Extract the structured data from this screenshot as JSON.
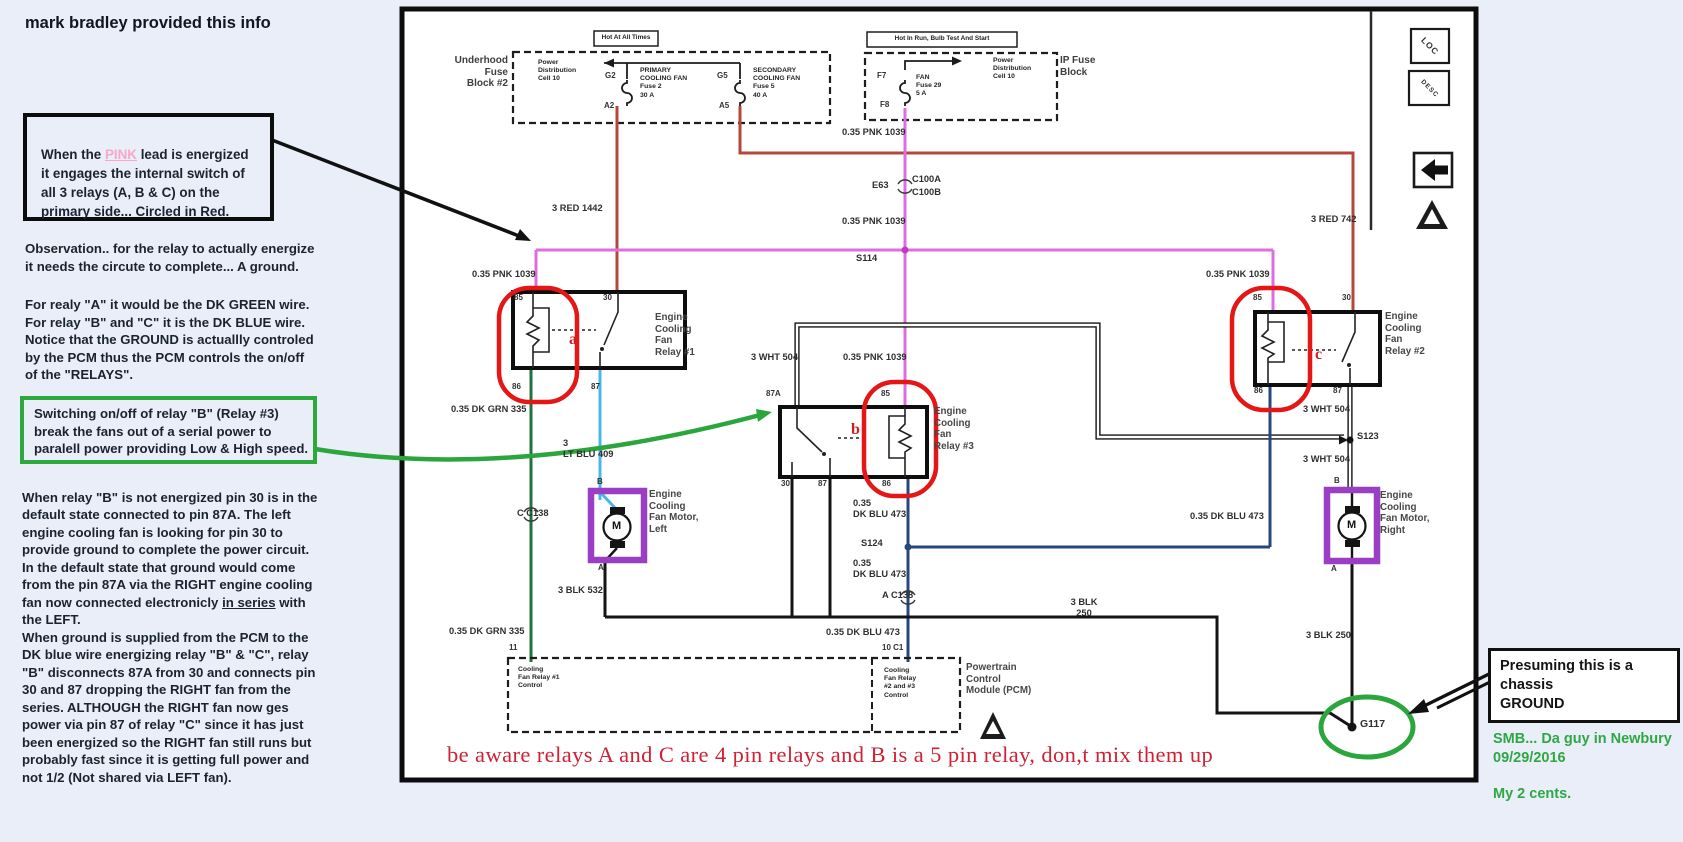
{
  "title": "mark bradley provided this info",
  "notes": {
    "pink_line1_pre": "When the ",
    "pink_word": "PINK",
    "pink_line1_post": " lead is energized",
    "pink_rest": "\nit engages the internal switch of\nall 3  relays (A, B & C) on the\nprimary side... Circled in Red.",
    "observation": "Observation.. for the relay to actually energize\nit needs the circute to complete... A ground.",
    "relay_wires": "For realy \"A\" it would be the DK GREEN wire.\nFor relay \"B\" and \"C\" it is the DK BLUE wire.\nNotice that the GROUND is actuallly controled\nby the PCM thus the PCM controls the on/off\nof the \"RELAYS\".",
    "green_note": "Switching on/off of relay  \"B\" (Relay #3)\nbreak the fans out of a serial power to\nparalell power  providing Low & High speed.",
    "long_a": "When relay \"B\" is not energized pin 30 is in the\ndefault state connected to pin 87A.  The left\nengine cooling fan is looking for pin 30 to\nprovide ground to complete the power circuit.\nIn the default state that ground would come\nfrom the pin 87A via the RIGHT engine cooling\nfan now connected electronicly ",
    "long_u": "in series",
    "long_b": " with\nthe LEFT.\nWhen ground is supplied from the PCM to the\nDK blue wire energizing relay \"B\" & \"C\", relay\n\"B\" disconnects 87A from 30 and connects pin\n30 and 87 dropping the RIGHT fan from the\nseries. ALTHOUGH the RIGHT fan now ges\npower via pin 87 of relay \"C\" since it has just\nbeen energized so the RIGHT fan still runs but\nprobably fast  since it is getting full power and\nnot 1/2   (Not shared via LEFT fan).",
    "red_warning": "be aware relays A and C are 4 pin relays and B is a 5 pin relay, don,t mix them up",
    "presuming": "Presuming this is a chassis\nGROUND",
    "smb_line1": "SMB... Da guy in Newbury\n09/29/2016",
    "smb_line2": "My 2 cents."
  },
  "colors": {
    "background": "#e9eef8",
    "pink_wire": "#de6ede",
    "red_wire": "#b5473a",
    "green_wire": "#23713f",
    "lt_blue_wire": "#49b8e8",
    "dk_blue_wire": "#27477f",
    "purple_marker": "#9a3fc4",
    "red_marker": "#e41616",
    "green_marker": "#2ba63c",
    "red_text": "#cf2236",
    "green_text": "#2fa844"
  },
  "diagram": {
    "underhood": {
      "header": "Hot At All Times",
      "block_label": "Underhood\nFuse\nBlock #2",
      "power_dist": "Power\nDistribution\nCell 10",
      "fuse1": "PRIMARY\nCOOLING FAN\nFuse 2\n30 A",
      "fuse1_pin_top": "G2",
      "fuse1_pin_bot": "A2",
      "fuse2": "SECONDARY\nCOOLING FAN\nFuse 5\n40 A",
      "fuse2_pin_top": "G5",
      "fuse2_pin_bot": "A5"
    },
    "ip": {
      "header": "Hot In Run, Bulb Test And Start",
      "block_label": "IP Fuse\nBlock",
      "power_dist": "Power\nDistribution\nCell 10",
      "fuse": "FAN\nFuse 29\n5 A",
      "pin_top": "F7",
      "pin_bot": "F8"
    },
    "wires": {
      "red1442": "3 RED 1442",
      "red742": "3 RED 742",
      "pnk_top": "0.35 PNK 1039",
      "pnk_mid": "0.35 PNK 1039",
      "pnk_left": "0.35 PNK 1039",
      "pnk_right": "0.35 PNK 1039",
      "pnk_b": "0.35 PNK 1039",
      "wht_b": "3 WHT 504",
      "wht_c_upper": "3 WHT 504",
      "wht_c_lower": "3 WHT 504",
      "dkgrn_upper": "0.35 DK GRN 335",
      "dkgrn_lower": "0.35 DK GRN 335",
      "ltblu": "3\nLT BLU 409",
      "blk532": "3 BLK 532",
      "dkblu_1": "0.35\nDK BLU 473",
      "dkblu_2": "0.35\nDK BLU 473",
      "dkblu_3": "0.35 DK BLU 473",
      "dkblu_right": "0.35 DK BLU 473",
      "blk250_h": "3 BLK\n250",
      "blk250_v": "3 BLK 250"
    },
    "connectors": {
      "e63": "E63",
      "c100a": "C100A",
      "c100b": "C100B",
      "s114": "S114",
      "s123": "S123",
      "s124": "S124",
      "c_c138": "C  C138",
      "a_c138": "A  C138",
      "g117": "G117",
      "pin11": "11",
      "pin10": "10 C1"
    },
    "relay_a": {
      "name": "Engine\nCooling\nFan\nRelay #1",
      "tag": "a",
      "p85": "85",
      "p30": "30",
      "p86": "86",
      "p87": "87"
    },
    "relay_b": {
      "name": "Engine\nCooling\nFan\nRelay #3",
      "tag": "b",
      "p87a": "87A",
      "p85": "85",
      "p30": "30",
      "p87": "87",
      "p86": "86"
    },
    "relay_c": {
      "name": "Engine\nCooling\nFan\nRelay #2",
      "tag": "c",
      "p85": "85",
      "p30": "30",
      "p86": "86",
      "p87": "87"
    },
    "motor_left": {
      "name": "Engine\nCooling\nFan Motor,\nLeft",
      "pin_top": "B",
      "pin_bot": "A",
      "m": "M"
    },
    "motor_right": {
      "name": "Engine\nCooling\nFan Motor,\nRight",
      "pin_top": "B",
      "pin_bot": "A",
      "m": "M"
    },
    "pcm": {
      "left": "Cooling\nFan Relay #1\nControl",
      "right": "Cooling\nFan Relay\n#2 and #3\nControl",
      "name": "Powertrain\nControl\nModule (PCM)"
    },
    "icons": {
      "loc": "LOC",
      "desc": "DESC"
    }
  }
}
